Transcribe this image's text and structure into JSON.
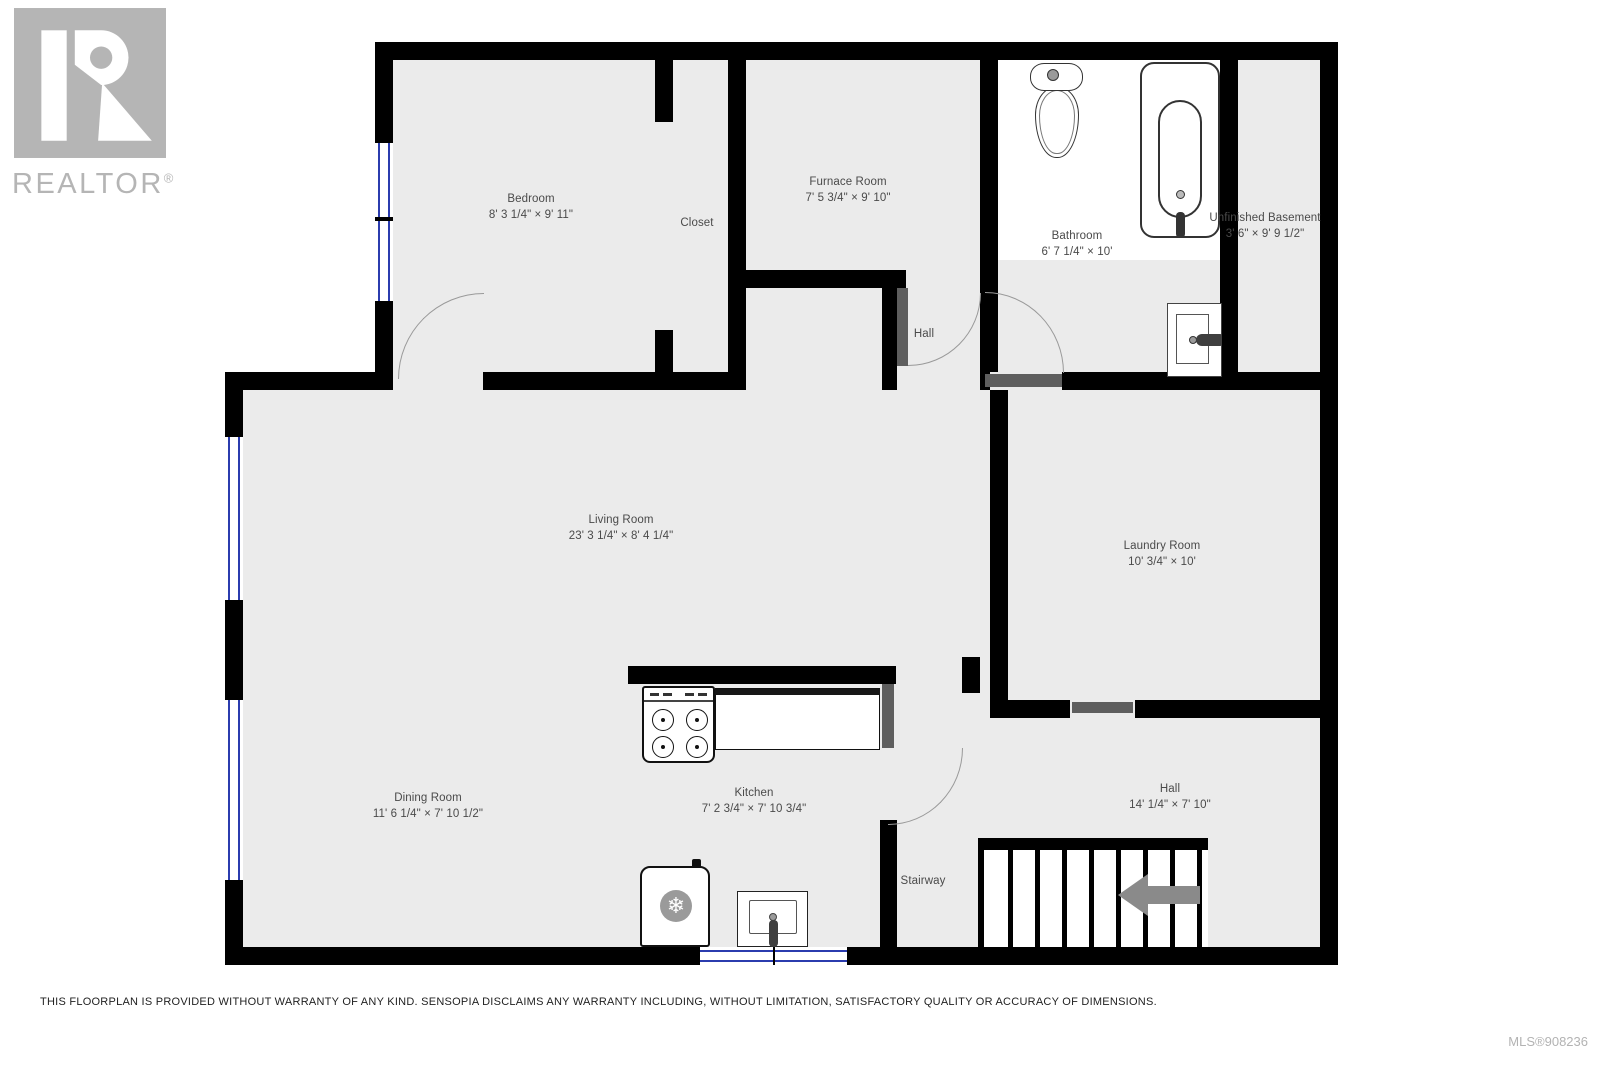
{
  "branding": {
    "logo_text": "REALTOR",
    "logo_reg": "®"
  },
  "rooms": {
    "bedroom": {
      "name": "Bedroom",
      "dims": "8' 3 1/4\" × 9' 11\""
    },
    "closet": {
      "name": "Closet",
      "dims": ""
    },
    "furnace": {
      "name": "Furnace Room",
      "dims": "7' 5 3/4\" × 9' 10\""
    },
    "bathroom": {
      "name": "Bathroom",
      "dims": "6' 7 1/4\" × 10'"
    },
    "unfinished": {
      "name": "Unfinished Basement",
      "dims": "3' 6\" × 9' 9 1/2\""
    },
    "hall_upper": {
      "name": "Hall",
      "dims": ""
    },
    "living": {
      "name": "Living Room",
      "dims": "23' 3 1/4\" × 8' 4 1/4\""
    },
    "laundry": {
      "name": "Laundry Room",
      "dims": "10' 3/4\" × 10'"
    },
    "dining": {
      "name": "Dining Room",
      "dims": "11' 6 1/4\" × 7' 10 1/2\""
    },
    "kitchen": {
      "name": "Kitchen",
      "dims": "7' 2 3/4\" × 7' 10 3/4\""
    },
    "hall_lower": {
      "name": "Hall",
      "dims": "14' 1/4\" × 7' 10\""
    },
    "stairway": {
      "name": "Stairway",
      "dims": ""
    }
  },
  "footer": {
    "disclaimer": "THIS FLOORPLAN IS PROVIDED WITHOUT WARRANTY OF ANY KIND. SENSOPIA DISCLAIMS ANY WARRANTY INCLUDING, WITHOUT LIMITATION, SATISFACTORY QUALITY OR ACCURACY OF DIMENSIONS.",
    "mls": "MLS®908236"
  },
  "colors": {
    "wall": "#000000",
    "floor": "#ebebeb",
    "leaf": "#5e5e5e",
    "arc": "#999999",
    "win": "#2b3cae",
    "label": "#4a4a4a",
    "logo": "#b5b5b5",
    "muted": "#b3b3b3"
  }
}
